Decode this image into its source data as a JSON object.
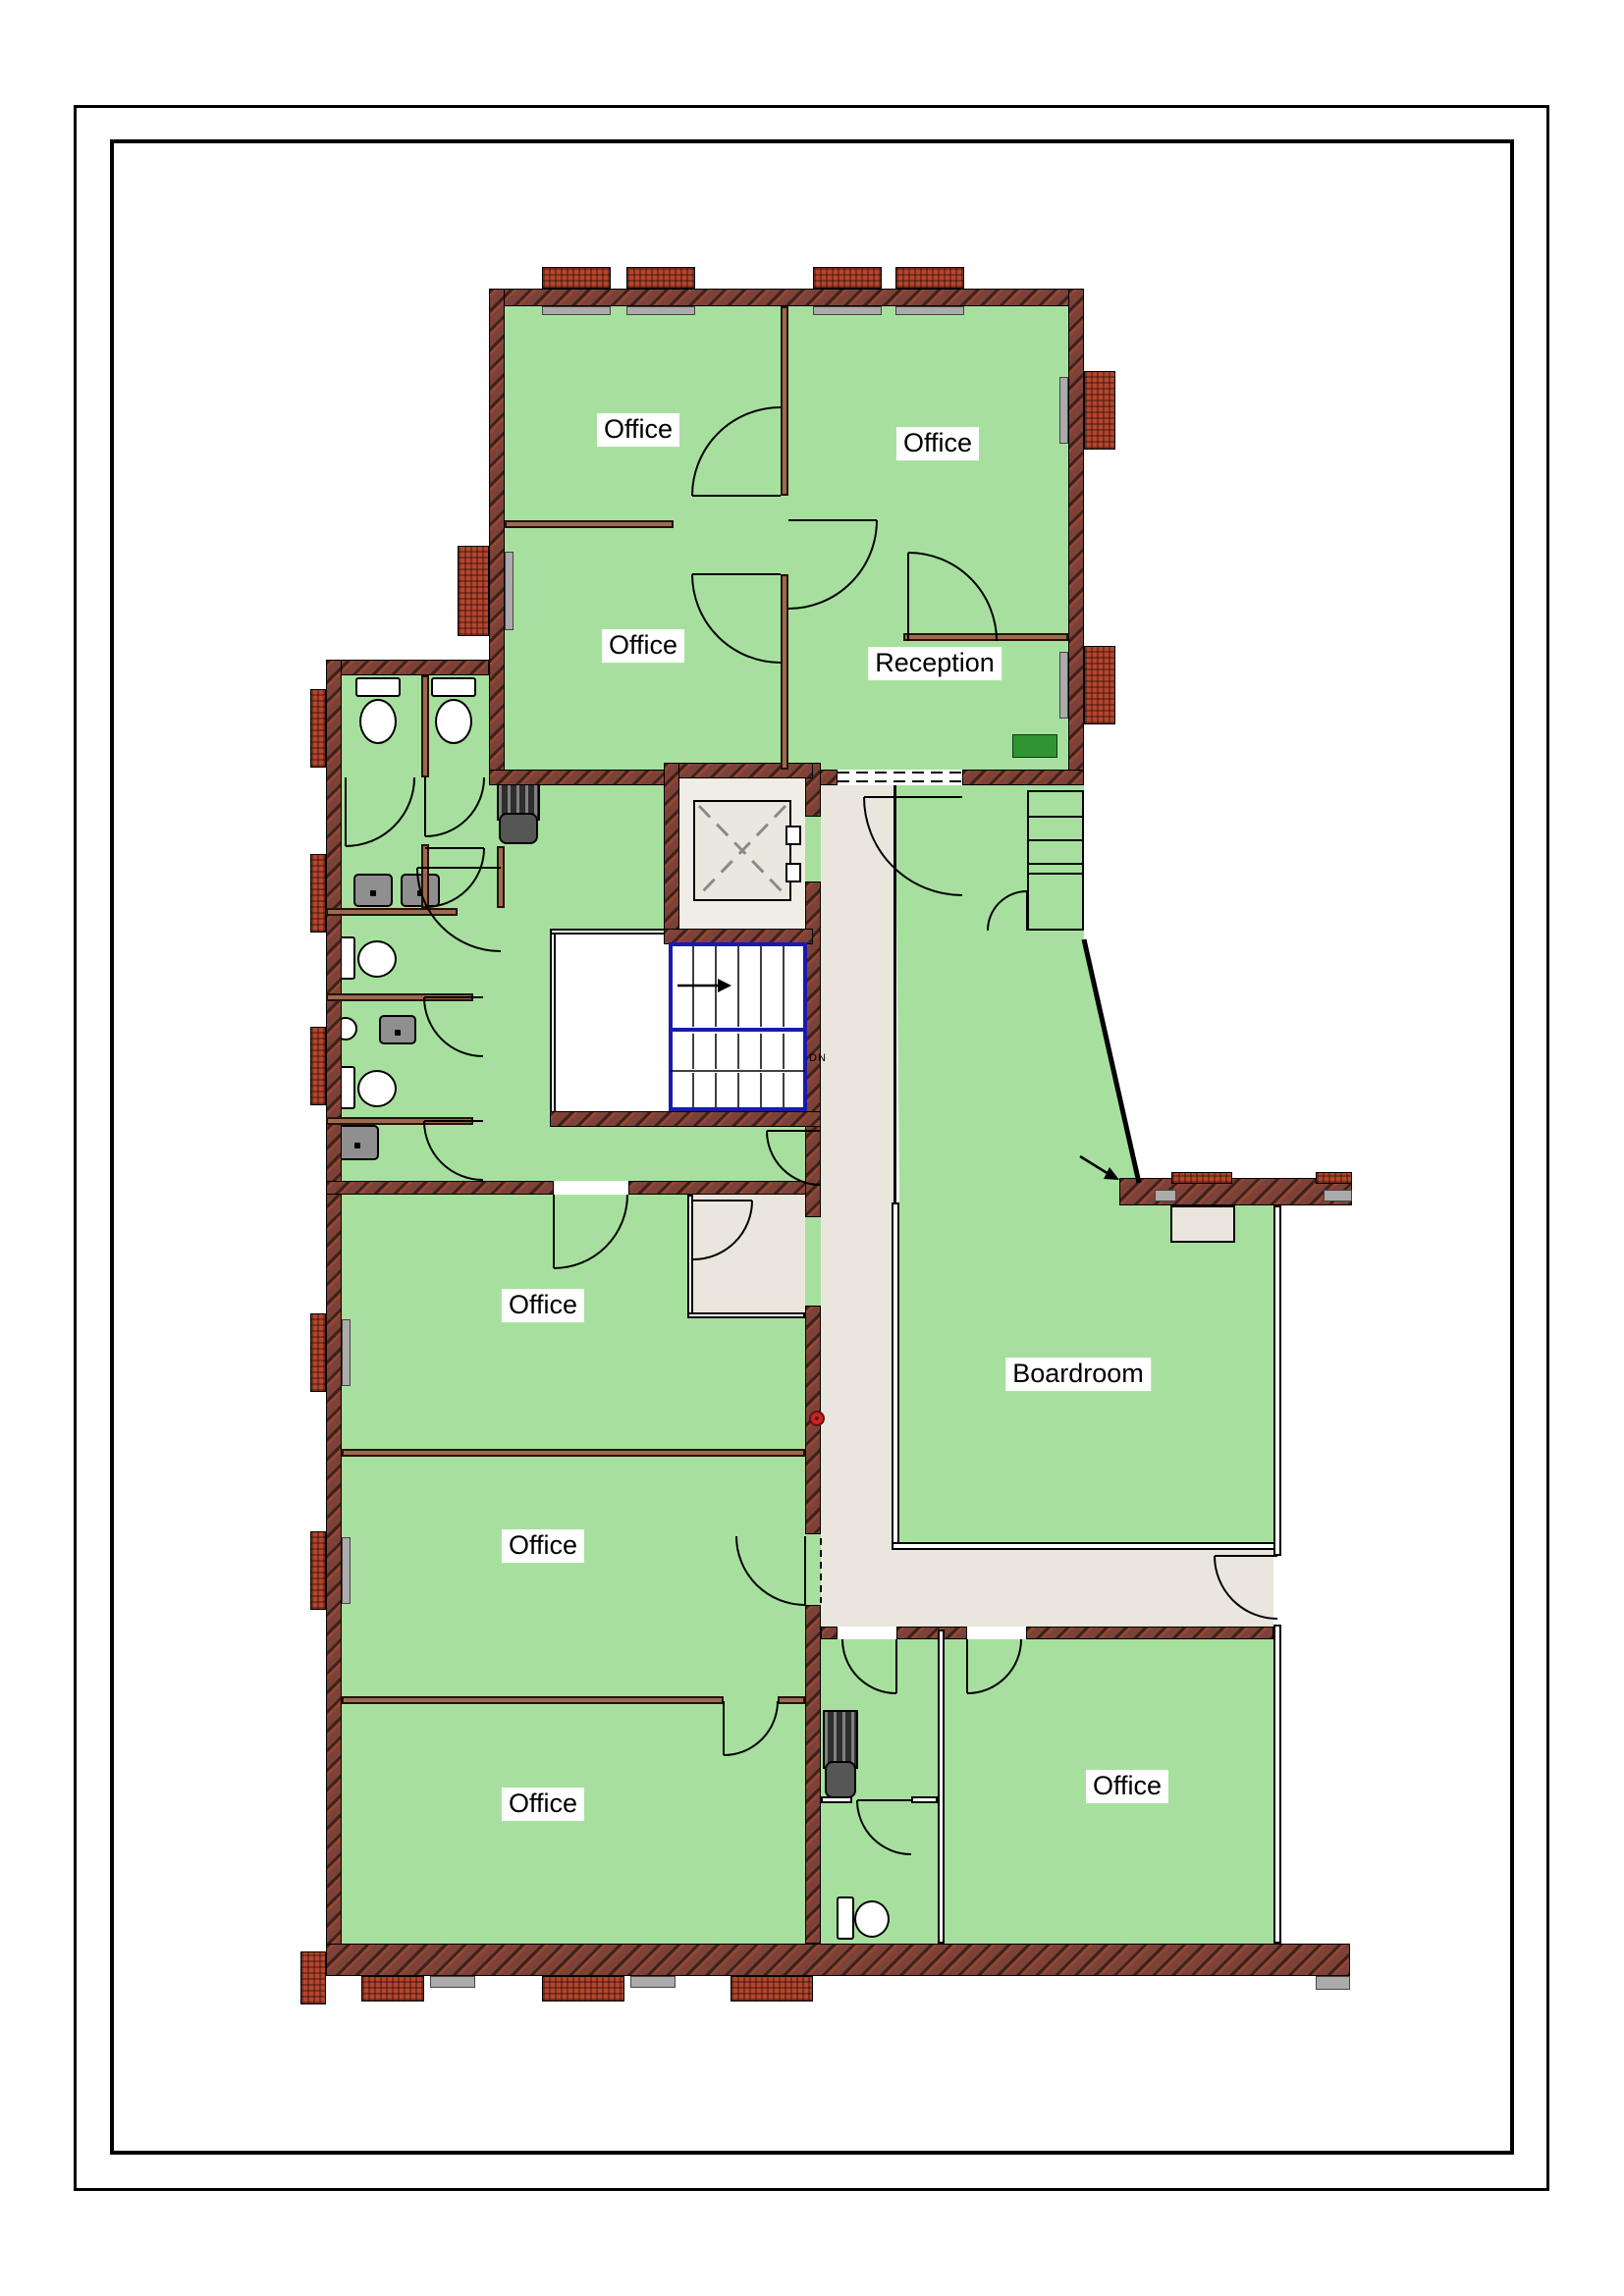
{
  "page": {
    "background": "#ffffff",
    "border_color": "#000000"
  },
  "plan": {
    "rooms": [
      {
        "id": "office-top-left",
        "label": "Office"
      },
      {
        "id": "office-top-right",
        "label": "Office"
      },
      {
        "id": "office-middle-left",
        "label": "Office"
      },
      {
        "id": "reception",
        "label": "Reception"
      },
      {
        "id": "office-left-upper",
        "label": "Office"
      },
      {
        "id": "office-left-middle",
        "label": "Office"
      },
      {
        "id": "office-left-lower",
        "label": "Office"
      },
      {
        "id": "boardroom",
        "label": "Boardroom"
      },
      {
        "id": "office-bottom-right",
        "label": "Office"
      }
    ],
    "stairs": {
      "down_label": "DN",
      "direction": "right"
    },
    "fixtures": [
      "toilet",
      "toilet",
      "toilet",
      "toilet",
      "toilet",
      "sink",
      "sink",
      "sink",
      "sink",
      "drinking-fountain",
      "radiator",
      "radiator",
      "elevator",
      "shelved-closet"
    ],
    "colors": {
      "room_fill": "#a7e09e",
      "accent_rect_green": "#2f9431",
      "exterior_wall_brick": "#7c4237",
      "window_brick": "#b5452c",
      "interior_wall_brown": "#9b6b4e",
      "corridor_fill": "#eae6dd",
      "stair_outline_blue": "#1a1ab0",
      "sill_gray": "#ababab",
      "door_dot_red": "#cc2222"
    }
  }
}
